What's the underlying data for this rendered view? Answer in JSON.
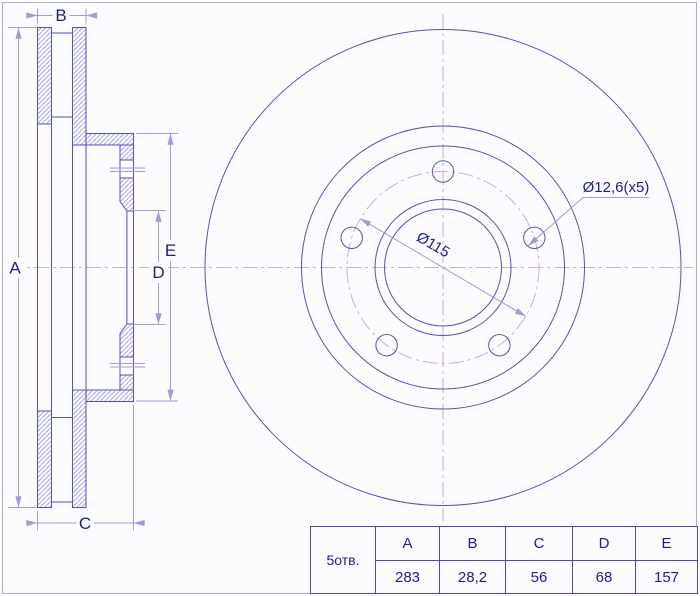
{
  "colors": {
    "background": "#fcfcfe",
    "line": "#5254b2",
    "hatch": "#9fa0da",
    "dim": "#a49ad6",
    "centerline": "#cfa9e0",
    "text": "#1d1d8f",
    "table_border": "#4848ac",
    "frame": "#a9aede"
  },
  "section_view": {
    "label_a": "A",
    "label_b": "B",
    "label_c": "C",
    "label_d": "D",
    "label_e": "E"
  },
  "front_view": {
    "bolt_circle_label": "Ø115",
    "bolt_hole_label": "Ø12,6(x5)"
  },
  "spec_table": {
    "row_label": "5отв.",
    "columns": [
      "A",
      "B",
      "C",
      "D",
      "E"
    ],
    "values": [
      "283",
      "28,2",
      "56",
      "68",
      "157"
    ]
  }
}
